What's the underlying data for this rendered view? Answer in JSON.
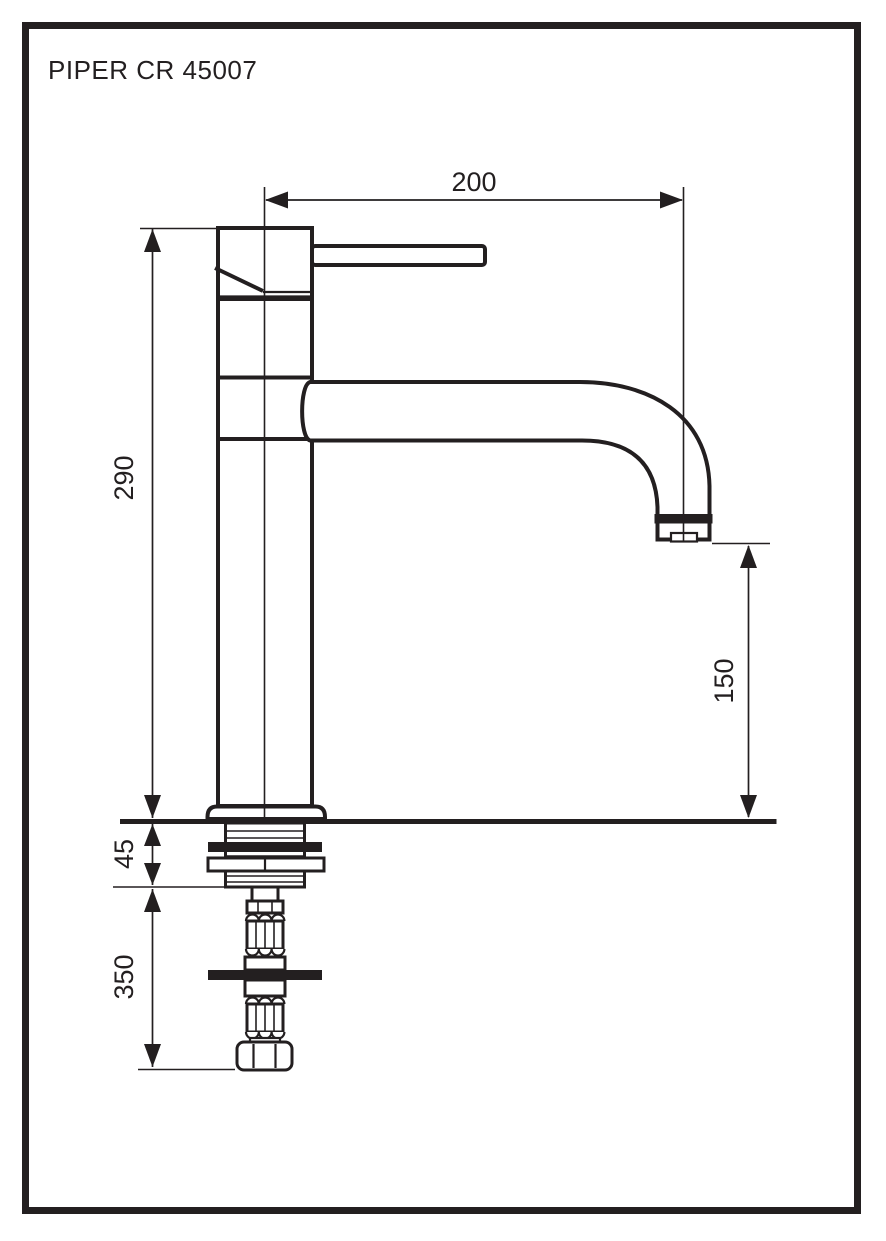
{
  "sheet": {
    "title": "PIPER CR 45007"
  },
  "dimensions": {
    "spout_reach_mm": "200",
    "height_to_top_mm": "290",
    "spout_outlet_height_mm": "150",
    "deck_mount_depth_mm": "45",
    "supply_hose_drop_mm": "350"
  },
  "colors": {
    "ink": "#231f20",
    "paper": "#ffffff"
  }
}
